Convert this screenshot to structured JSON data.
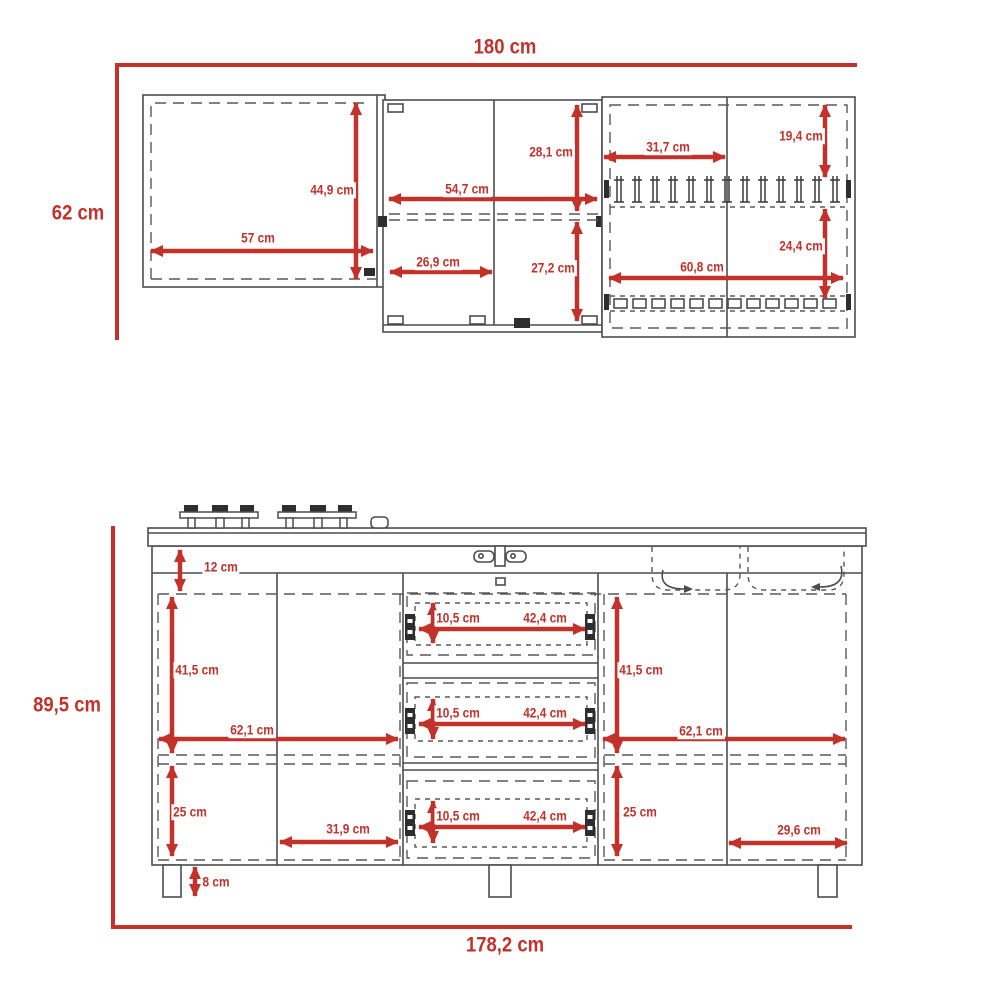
{
  "meta": {
    "unit": "cm",
    "accent_color": "#c2322b",
    "line_color": "#4c4c4c"
  },
  "upper_cabinet": {
    "width_total": "180 cm",
    "height_total": "62 cm",
    "left": {
      "width": "57 cm",
      "height": "44,9 cm"
    },
    "center": {
      "width": "54,7 cm",
      "door_width": "26,9 cm",
      "top_height": "28,1 cm",
      "bottom_height": "27,2 cm"
    },
    "right": {
      "door_width": "31,7 cm",
      "width": "60,8 cm",
      "top_height": "19,4 cm",
      "bottom_height": "24,4 cm"
    }
  },
  "base_cabinet": {
    "height_total": "89,5 cm",
    "width_total": "178,2 cm",
    "counter_inset": "12 cm",
    "left": {
      "top_height": "41,5 cm",
      "width": "62,1 cm",
      "bottom_height": "25 cm",
      "door_width": "31,9 cm"
    },
    "drawers": [
      {
        "height": "10,5 cm",
        "width": "42,4 cm"
      },
      {
        "height": "10,5 cm",
        "width": "42,4 cm"
      },
      {
        "height": "10,5 cm",
        "width": "42,4 cm"
      }
    ],
    "right": {
      "top_height": "41,5 cm",
      "width": "62,1 cm",
      "bottom_height": "25 cm",
      "door_width": "29,6 cm"
    },
    "leg_height": "8 cm"
  }
}
